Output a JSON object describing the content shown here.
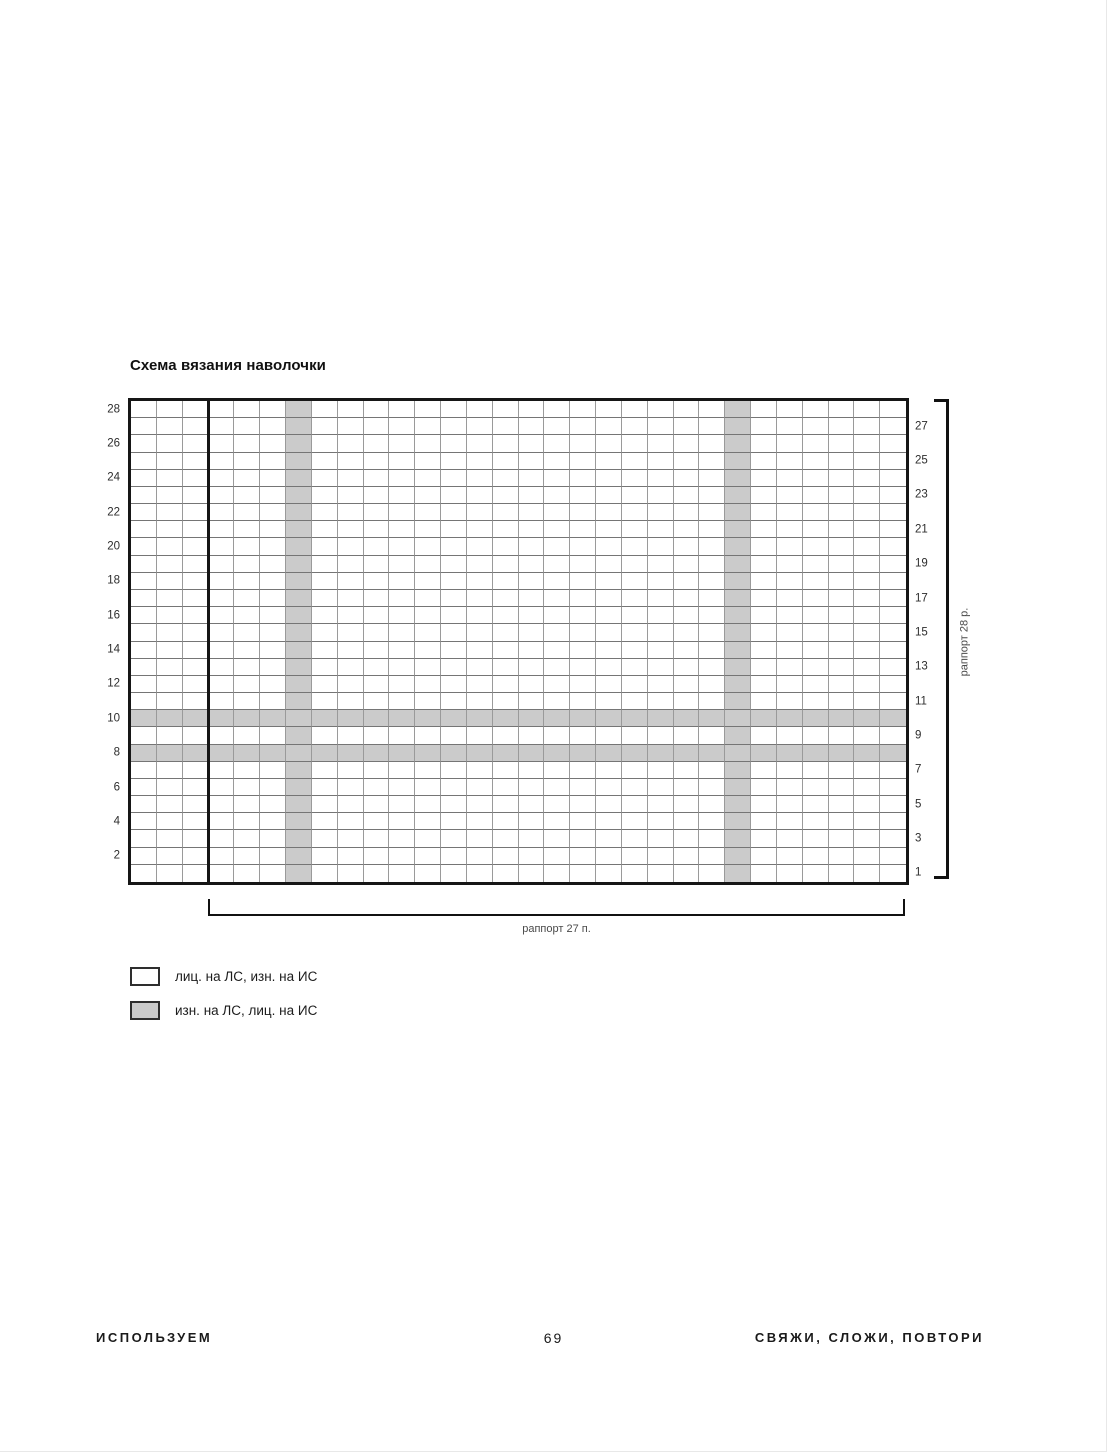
{
  "page": {
    "title": "Схема вязания наволочки",
    "footer": {
      "left": "ИСПОЛЬЗУЕМ",
      "page_number": "69",
      "right": "СВЯЖИ, СЛОЖИ, ПОВТОРИ"
    }
  },
  "chart_data": {
    "type": "heatmap",
    "title": "Схема вязания наволочки",
    "description": "Knitting chart: 30 stitch columns x 28 rows; gray cells = purl on right side; vertical gray columns run the full height at stitches 7 and 24 from the left; horizontal gray bands run the full width at rows 8 and 10 from the bottom; bold vertical line after the 3rd column from the left marks the start of the 27-stitch repeat",
    "columns": 30,
    "rows": 28,
    "gray_columns_from_left": [
      7,
      24
    ],
    "gray_rows_from_bottom": [
      8,
      10
    ],
    "repeat_line_after_column_from_left": 3,
    "stitch_repeat_count": 27,
    "row_repeat_count": 28,
    "plain_color": "#ffffff",
    "gray_color": "#cbcbcb",
    "grid_line_color": "#8d8d8d",
    "border_color": "#161616",
    "left_row_labels": [
      "28",
      "26",
      "24",
      "22",
      "20",
      "18",
      "16",
      "14",
      "12",
      "10",
      "8",
      "6",
      "4",
      "2"
    ],
    "right_row_labels": [
      "27",
      "25",
      "23",
      "21",
      "19",
      "17",
      "15",
      "13",
      "11",
      "9",
      "7",
      "5",
      "3",
      "1"
    ],
    "bottom_bracket_label": "раппорт 27 п.",
    "right_bracket_label": "раппорт 28 р."
  },
  "legend": {
    "items": [
      {
        "swatch": "white",
        "label": "лиц. на ЛС, изн. на ИС"
      },
      {
        "swatch": "gray",
        "label": "изн. на ЛС, лиц. на ИС"
      }
    ]
  }
}
